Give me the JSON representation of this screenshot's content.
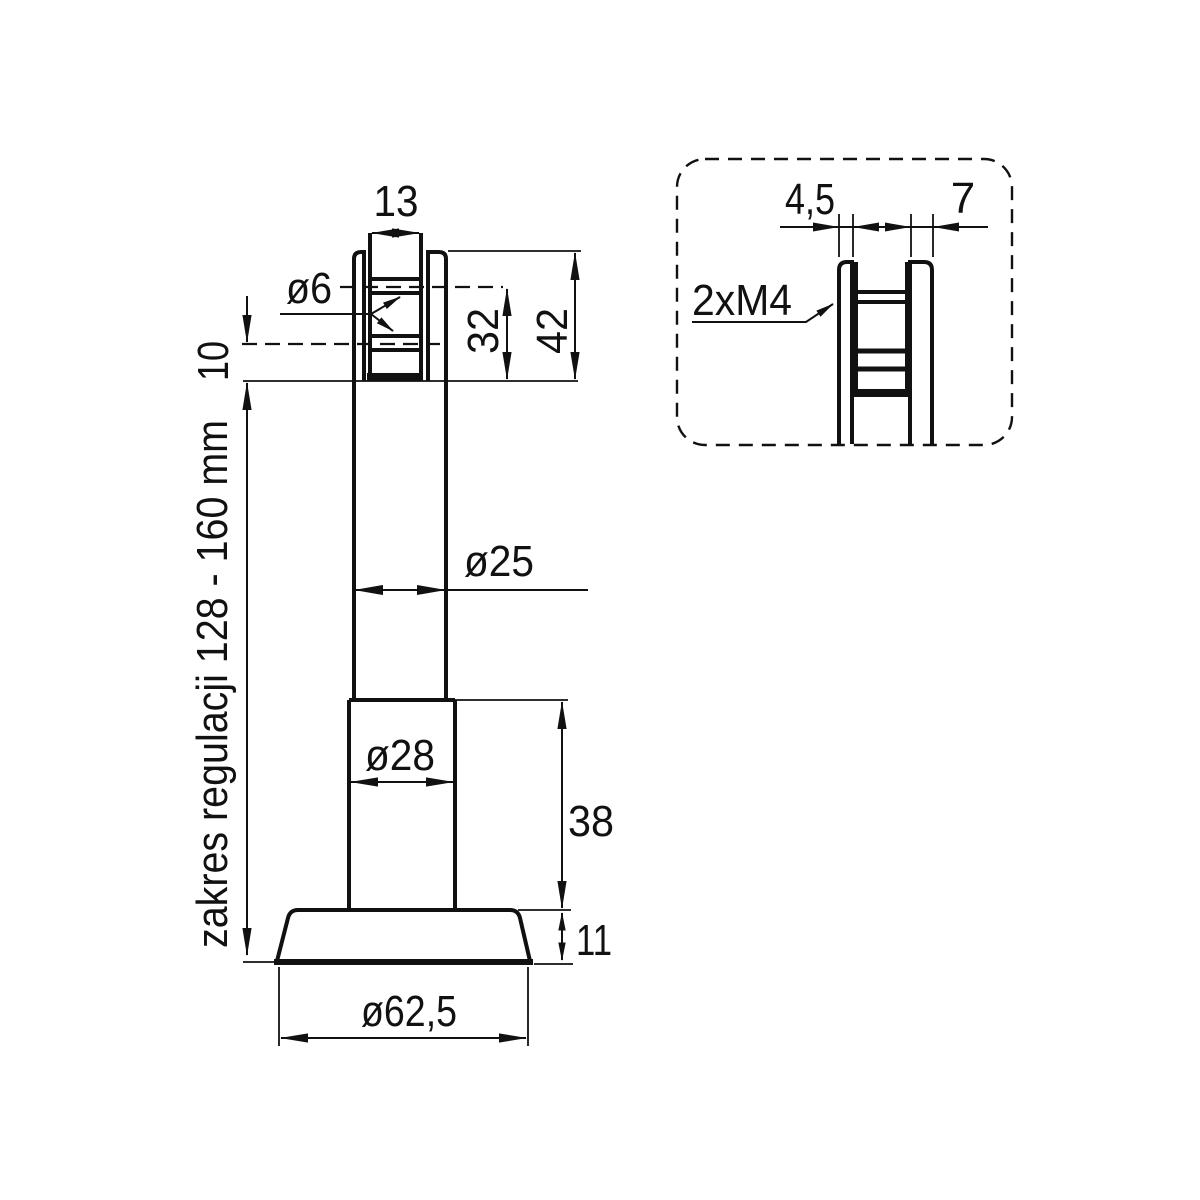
{
  "drawing": {
    "title": "adjustable-post-technical-drawing",
    "colors": {
      "line": "#111111",
      "background": "#ffffff"
    },
    "labels": {
      "top_width": "13",
      "hole_diameter": "ø6",
      "offset": "10",
      "adjustment_range": "zakres regulacji 128 - 160 mm",
      "slot_depth": "32",
      "clamp_height": "42",
      "tube_diameter": "ø25",
      "sleeve_diameter": "ø28",
      "sleeve_height": "38",
      "base_height": "11",
      "base_diameter": "ø62,5",
      "detail_plate_left_thickness": "4,5",
      "detail_plate_right_thickness": "7",
      "thread_spec": "2xM4"
    }
  }
}
